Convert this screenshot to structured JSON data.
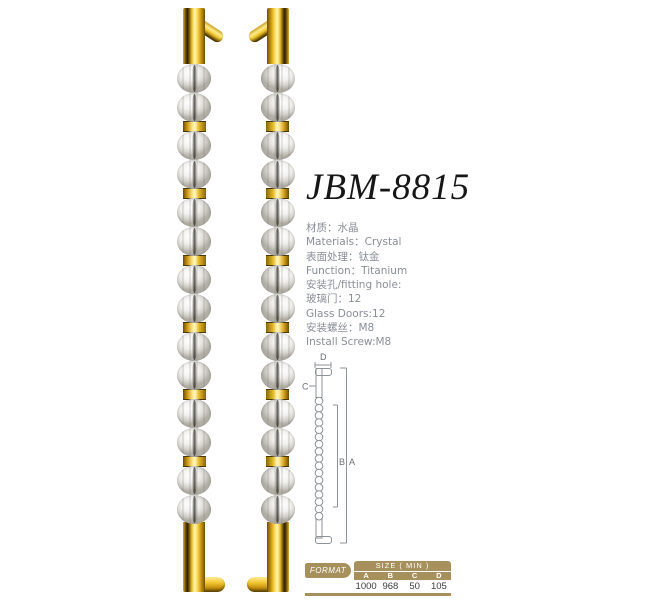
{
  "product": {
    "model": "JBM-8815"
  },
  "specs": [
    "材质：水晶",
    "Materials：Crystal",
    "表面处理：钛金",
    "Function：Titanium",
    "安装孔/fitting hole:",
    "玻璃门：12",
    "Glass Doors:12",
    "安装螺丝：M8",
    "Install Screw:M8"
  ],
  "handles": {
    "description": "pair of gold titanium pull handles with fluted crystal balls",
    "bead_pairs": 7
  },
  "diagram": {
    "bead_count": 17,
    "labels": {
      "a": "A",
      "b": "B",
      "c": "C",
      "d": "D"
    }
  },
  "size_table": {
    "format_label": "FORMAT",
    "size_header": "SIZE ( MIN )",
    "columns": [
      "A",
      "B",
      "C",
      "D"
    ],
    "values": [
      "1000",
      "968",
      "50",
      "105"
    ]
  },
  "colors": {
    "gold": "#e8bd2a",
    "gold_dark": "#6b4d05",
    "table_tan": "#a6915c",
    "spec_text_gray": "#8a8f97",
    "diagram_line_gray": "#8d9297",
    "title_black": "#161616"
  }
}
